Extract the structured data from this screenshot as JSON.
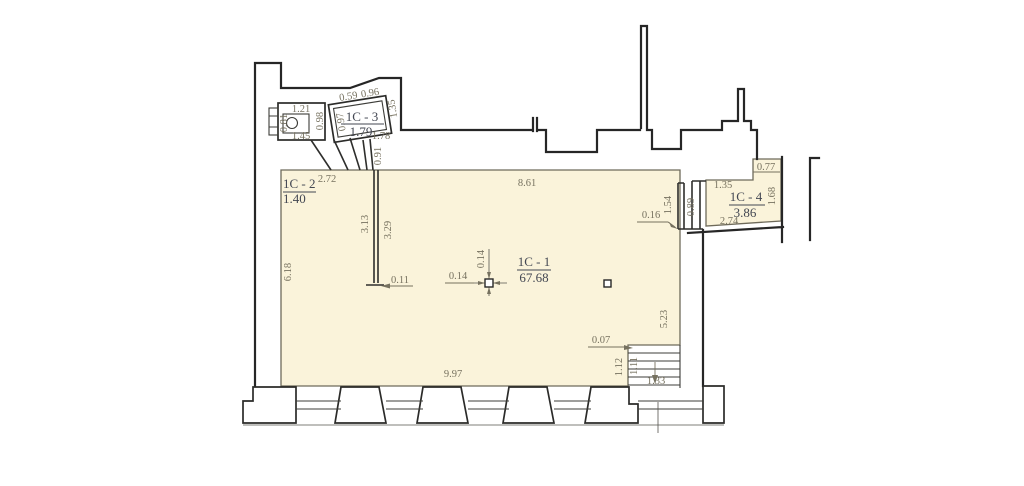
{
  "document": {
    "type": "architectural floor plan"
  },
  "colors": {
    "background": "#FFFFFF",
    "room_fill": "#FAF3DA",
    "wall": "#262626",
    "dim_text": "#76715F",
    "label_text": "#434752"
  },
  "rooms": {
    "c1": {
      "name": "1C - 1",
      "area": "67.68"
    },
    "c2": {
      "name": "1C - 2",
      "area": "1.40"
    },
    "c3": {
      "name": "1C - 3",
      "area": "1.79"
    },
    "c4": {
      "name": "1C - 4",
      "area": "3.86"
    }
  },
  "dims": {
    "c1_top": "8.61",
    "c1_left": "6.18",
    "c1_bottom": "9.97",
    "c1_right": "5.23",
    "partition_left": "3.13",
    "partition_right": "3.29",
    "partition_end": "0.11",
    "column_w": "0.14",
    "column_h": "0.14",
    "c2_width": "2.72",
    "annex_top": "1.21",
    "annex_left": "0.81",
    "annex_bottom": "1.45",
    "annex_right": "0.98",
    "c3_left": "0.97",
    "c3_top_left": "0.59",
    "c3_top_right": "0.96",
    "c3_right": "1.35",
    "c3_bottom": "1.78",
    "c3_passage": "0.91",
    "niche_height": "1.54",
    "niche_offset": "0.16",
    "shaft_width": "0.89",
    "c4_notch": "0.77",
    "c4_upper": "1.35",
    "c4_right": "1.68",
    "c4_bottom": "2.74",
    "stair_wall": "0.07",
    "stair_left": "1.12",
    "stair_inner": "1.11",
    "stair_width": "1.33"
  }
}
